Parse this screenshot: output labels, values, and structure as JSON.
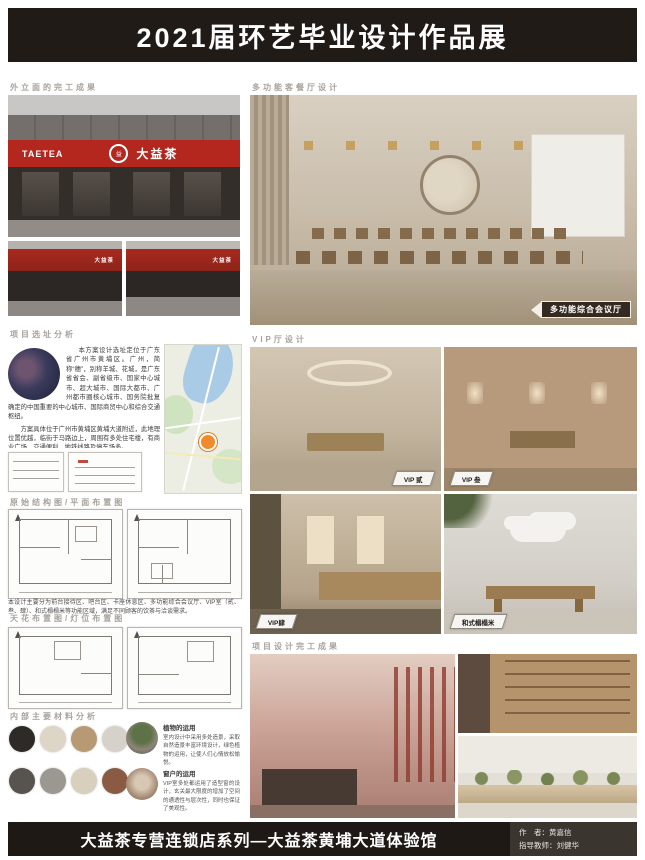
{
  "title": "2021届环艺毕业设计作品展",
  "headings": {
    "facade": "外立面的完工成果",
    "multifunction": "多功能客餐厅设计",
    "site": "项目选址分析",
    "floor_plans": "原始结构图/平面布置图",
    "ceiling_plans": "天花布置图/灯位布置图",
    "materials": "内部主要材料分析",
    "vip": "VIP厅设计",
    "completion": "项目设计完工成果"
  },
  "storefront": {
    "brand_en": "TAETEA",
    "brand_cn": "大益茶",
    "logo_glyph": "益"
  },
  "site": {
    "intro": "本方案设计选址定位于广东省广州市黄埔区。广州，简称“穗”，别称羊城、花城，是广东省省会、副省级市、国家中心城市、超大城市、国际大都市、广州都市圈核心城市、国务院批复确定的中国重要的中心城市、国际商贸中心和综合交通枢纽。",
    "detail": "方案具体位于广州市黄埔区黄埔大道附近，此地理位置优越，临街于马路边上，周围有多处住宅楼，有商业广场，交通便利，地铁线路及停车场多。"
  },
  "plans_note": "本设计主要分为前台接待区、吧台区、卡座休息区、多功能综合会议厅、VIP室（贰、叁、肆）、和式榻榻米等功能区域，满足不同顾客的饮茶与洽谈需求。",
  "tags": {
    "conference": "多功能综合会议厅",
    "vip2": "VIP 贰",
    "vip3": "VIP 叁",
    "vip4": "VIP肆",
    "tatami": "和式榻榻米"
  },
  "materials": {
    "items": [
      {
        "title": "植物的运用",
        "text": "室内设计中采用多处造景，采取自然造景丰富环境设计，绿色植物的运用，让使人们心情放松愉悦。"
      },
      {
        "title": "窗户的运用",
        "text": "VIP室多处都运用了造型窗的设计，玄关最大限度的增加了空间的通透性与层次性，同时也保证了美观性。"
      }
    ]
  },
  "footer": {
    "title": "大益茶专营连锁店系列—大益茶黄埔大道体验馆",
    "author": "作　者：黄嘉信",
    "advisor": "指导教师：刘健华"
  },
  "colors": {
    "brand_red": "#b3271e",
    "banner_black": "#201b16",
    "tag_dark": "#342a20"
  }
}
